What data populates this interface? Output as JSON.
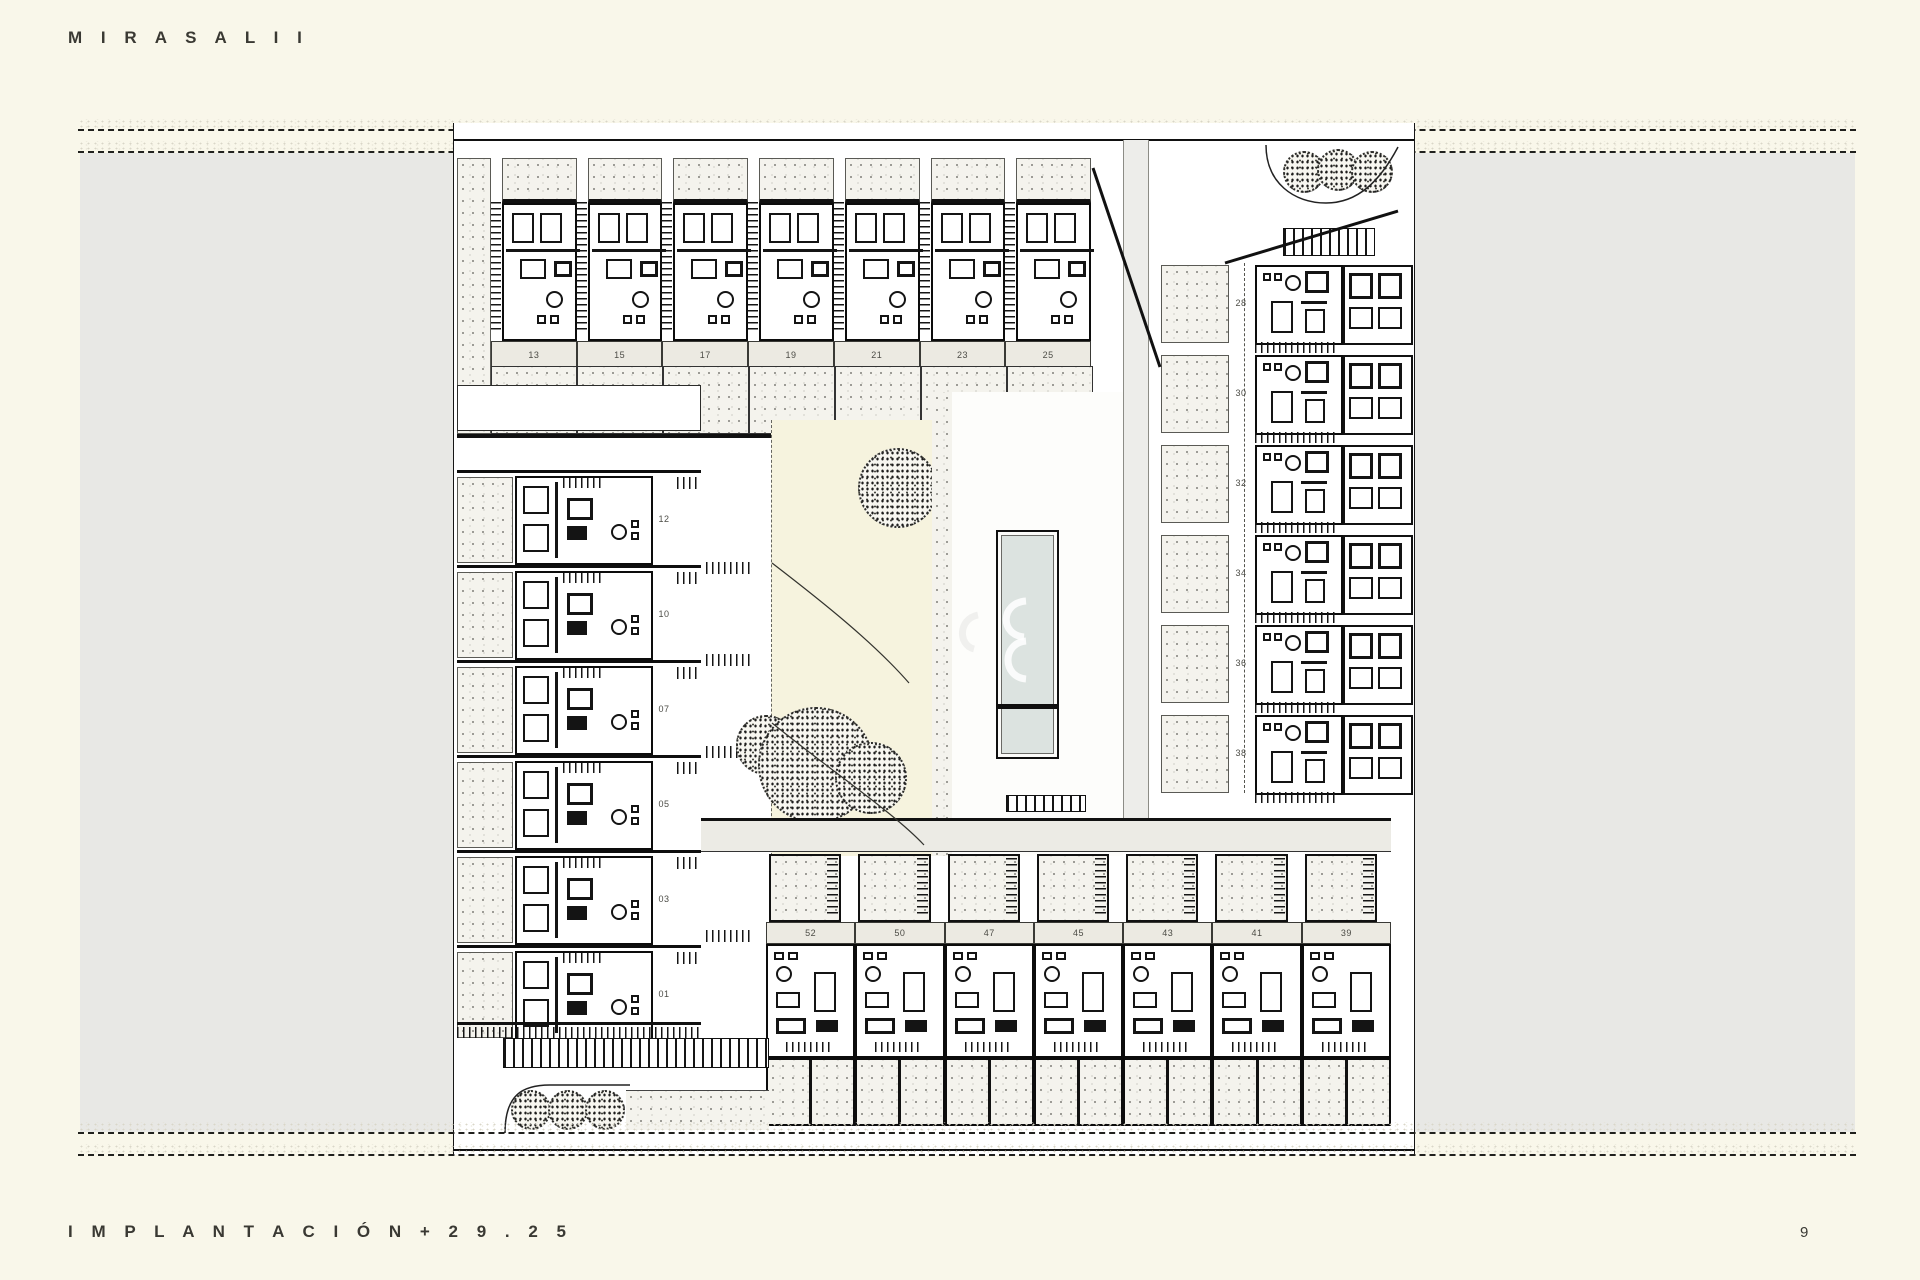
{
  "page": {
    "title": "M I R A S A L   I I",
    "footer": "I M P L A N T A C I Ó N   + 2 9 . 2 5",
    "page_number": "9"
  },
  "plan": {
    "top_row_units": [
      "13",
      "15",
      "17",
      "19",
      "21",
      "23",
      "25"
    ],
    "left_column_units": [
      "12",
      "10",
      "07",
      "05",
      "03",
      "01"
    ],
    "right_column_units": [
      "28",
      "30",
      "32",
      "34",
      "36",
      "38"
    ],
    "bottom_row_units": [
      "52",
      "50",
      "47",
      "45",
      "43",
      "41",
      "39"
    ]
  },
  "colors": {
    "page_background": "#f9f7ea",
    "margin_panel_gray": "#e8e8e5",
    "drawing_ink": "#141414",
    "pool_water": "#dce3e0",
    "garden_ground": "#f6f3de",
    "number_band": "#eceae2"
  }
}
